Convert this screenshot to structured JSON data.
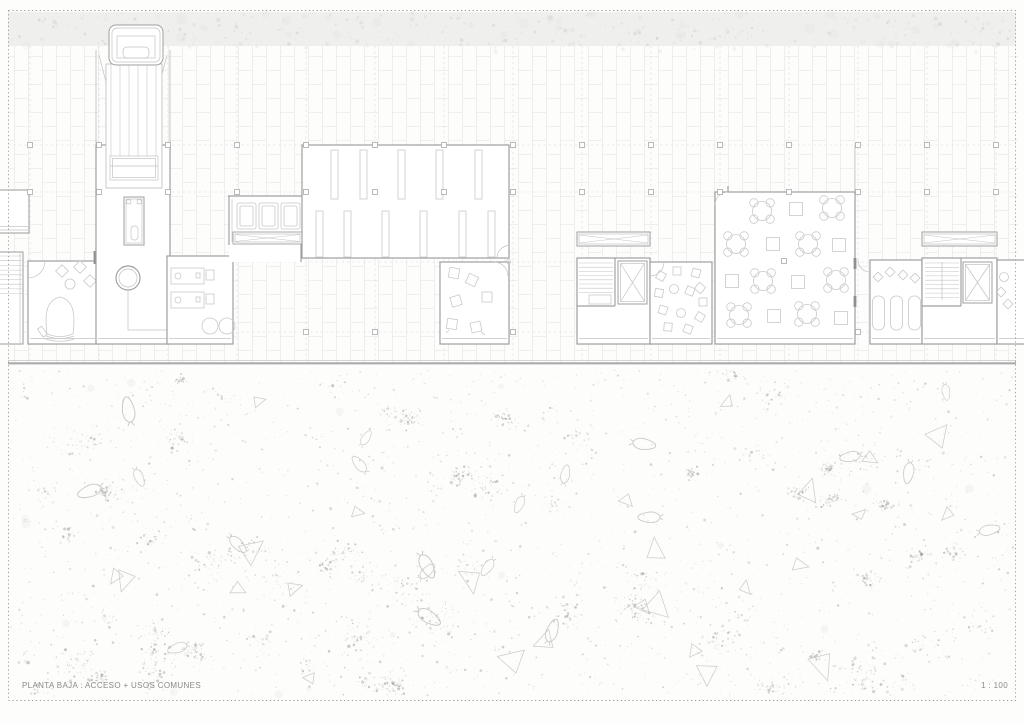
{
  "page": {
    "title_label": "PLANTA BAJA : ACCESO + USOS COMUNES",
    "scale_label": "1 : 100"
  },
  "colors": {
    "paper": "#fdfdfc",
    "wall": "#9f9f9f",
    "thin": "#c3c3c3",
    "furn": "#c9c9c9",
    "tile": "#e6e6e6",
    "dash": "#d9d9d9",
    "col": "#aaaaaa",
    "band": "#efefee",
    "stip": "#8e8e8e",
    "shape": "#c7c7c7",
    "groundline": "#ababab",
    "jamb": "#8f8f8f",
    "text": "#8a8a8a",
    "roomfill": "#ffffff"
  },
  "column_grid": {
    "x_start": 30,
    "x_step": 69,
    "x_count": 15,
    "rows_main": [
      145,
      192
    ],
    "row_low": 332,
    "row_mid_column_x": 784
  },
  "ground_texture": {
    "dots": 2600,
    "clusters": 72,
    "triangles": 26,
    "leaves": 20,
    "top": 370,
    "bottom": 696
  },
  "top_band": {
    "speckles": 330,
    "top": 12,
    "bottom": 46
  }
}
